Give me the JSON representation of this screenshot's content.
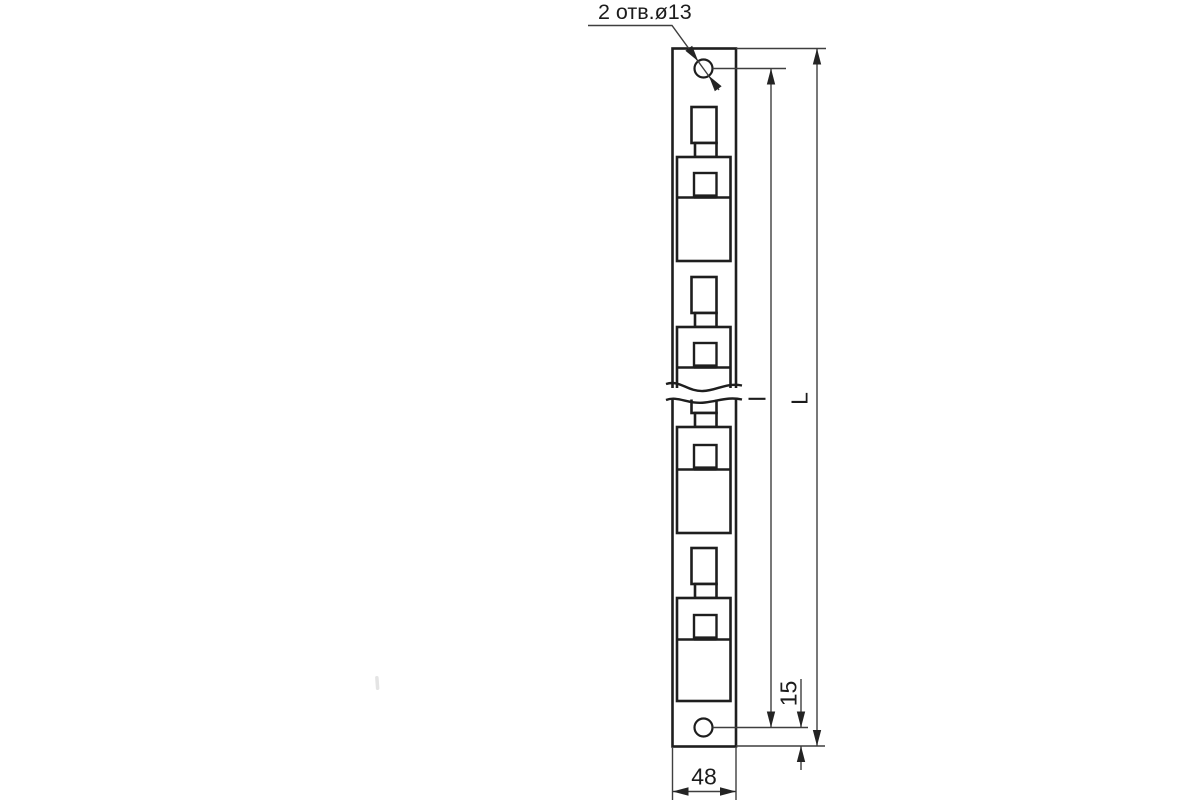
{
  "annotations": {
    "holes_note": "2 отв.ø13",
    "width": "48",
    "hole_edge_offset": "15",
    "overall_length_label": "L",
    "hole_spacing_label": "l"
  },
  "colors": {
    "line": "#1e1e1e",
    "dimension_line": "#3f3f3f",
    "text": "#1c1c1c",
    "background": "#ffffff"
  }
}
